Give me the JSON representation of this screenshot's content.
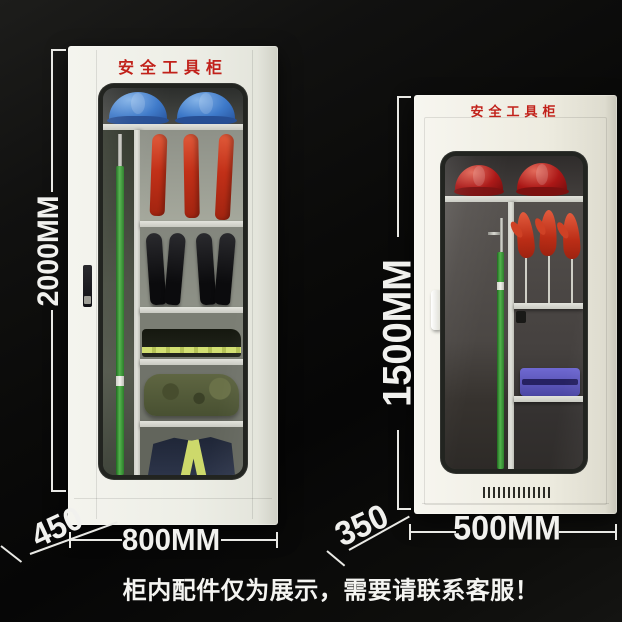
{
  "scene": {
    "caption": "柜内配件仅为展示，需要请联系客服！",
    "background_color": "#0a0a09",
    "annotation_color": "#e9e9e5",
    "title_color": "#c1211a"
  },
  "cabinet_large": {
    "title": "安全工具柜",
    "body_color": "#edeee6",
    "dimensions": {
      "height": "2000MM",
      "width": "800MM",
      "depth": "450"
    },
    "items": [
      "blue-safety-helmet",
      "blue-safety-helmet",
      "insulated-glove",
      "insulated-glove",
      "insulated-glove",
      "green-insulating-rod",
      "insulated-boots-pair",
      "insulated-boots-pair",
      "folded-workwear-with-reflective-stripe",
      "olive-tool-bag",
      "navy-uniform-with-reflective-stripes"
    ],
    "item_colors": {
      "helmet": "#3d79c9",
      "glove": "#c23018",
      "rod": "#53b34d"
    }
  },
  "cabinet_small": {
    "title": "安全工具柜",
    "body_color": "#edebdf",
    "dimensions": {
      "height": "1500MM",
      "width": "500MM",
      "depth": "350"
    },
    "items": [
      "red-safety-helmet",
      "red-safety-helmet",
      "insulated-glove",
      "insulated-glove",
      "insulated-glove",
      "green-insulating-rod",
      "purple-tool-case",
      "ventilation-grille"
    ],
    "item_colors": {
      "helmet": "#ab1716",
      "glove": "#bb2d16",
      "rod": "#53b34d",
      "toolbox": "#4b46a4"
    }
  }
}
